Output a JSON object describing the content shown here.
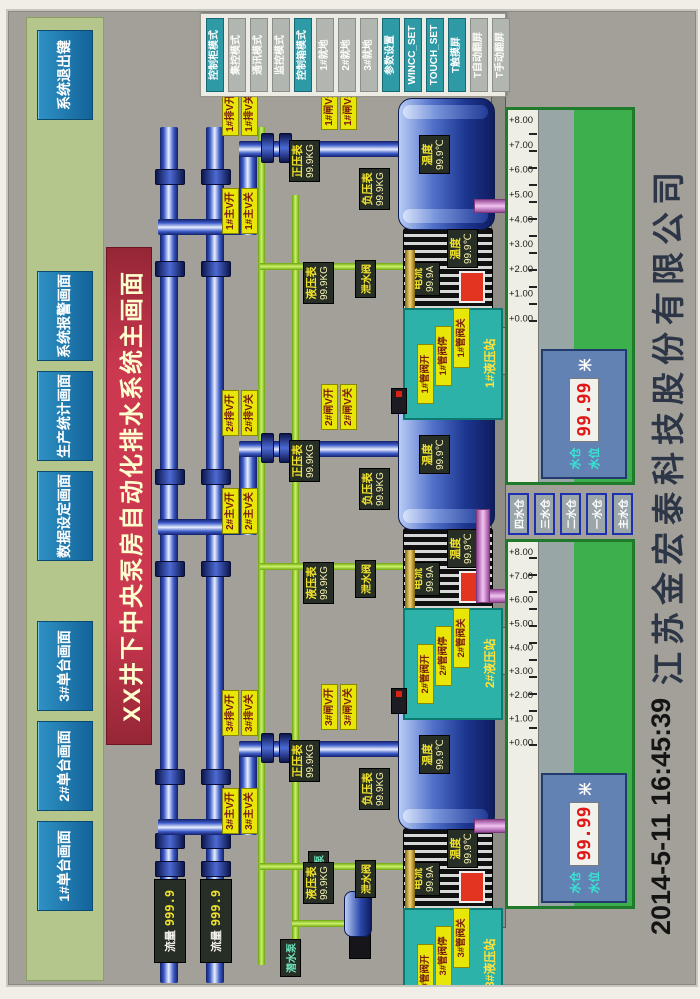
{
  "title": "XX井下中央泵房自动化排水系统主画面",
  "toolbar": {
    "buttons": [
      "1#单台画面",
      "2#单台画面",
      "3#单台画面",
      "数据设定画面",
      "生产统计画面",
      "系统报警画面",
      "系统退出键"
    ]
  },
  "mode_panel": {
    "buttons": [
      {
        "label": "控制柜模式",
        "variant": "teal"
      },
      {
        "label": "集控模式",
        "variant": "gray"
      },
      {
        "label": "通讯模式",
        "variant": "gray"
      },
      {
        "label": "监控模式",
        "variant": "gray"
      },
      {
        "label": "控制箱模式",
        "variant": "teal"
      },
      {
        "label": "1#就地",
        "variant": "gray"
      },
      {
        "label": "2#就地",
        "variant": "gray"
      },
      {
        "label": "3#就地",
        "variant": "gray"
      },
      {
        "label": "参数设置",
        "variant": "teal"
      },
      {
        "label": "WINCC_SET",
        "variant": "teal"
      },
      {
        "label": "TOUCH_SET",
        "variant": "teal"
      },
      {
        "label": "T触摸屏",
        "variant": "teal"
      },
      {
        "label": "T自动翻屏",
        "variant": "gray"
      },
      {
        "label": "T手动翻屏",
        "variant": "gray"
      }
    ]
  },
  "pumps": [
    {
      "id": "3#",
      "valves": {
        "drain_open": "3#排V开",
        "drain_close": "3#排V关",
        "main_open": "3#主V开",
        "main_close": "3#主V关",
        "gate_open": "3#闸V开",
        "gate_close": "3#闸V关"
      },
      "gauges": {
        "positive": {
          "label": "正压表",
          "value": "99.9KG"
        },
        "vacuum": {
          "label": "负压表",
          "value": "99.9KG"
        },
        "hydraulic": {
          "label": "液压表",
          "value": "99.9KG"
        },
        "drain_valve": "泄水阀"
      },
      "pump_temp": {
        "label": "温度",
        "value": "99.9℃"
      },
      "motor_current": {
        "label": "电流",
        "value": "99.9A"
      },
      "motor_temp": {
        "label": "温度",
        "value": "99.9℃"
      },
      "hydraulic_panel": {
        "open": "3#管阀开",
        "stop": "3#管阀停",
        "close": "3#管阀关",
        "station": "3#液压站"
      }
    },
    {
      "id": "2#",
      "valves": {
        "drain_open": "2#排V开",
        "drain_close": "2#排V关",
        "main_open": "2#主V开",
        "main_close": "2#主V关",
        "gate_open": "2#闸V开",
        "gate_close": "2#闸V关"
      },
      "gauges": {
        "positive": {
          "label": "正压表",
          "value": "99.9KG"
        },
        "vacuum": {
          "label": "负压表",
          "value": "99.9KG"
        },
        "hydraulic": {
          "label": "液压表",
          "value": "99.9KG"
        },
        "drain_valve": "泄水阀"
      },
      "pump_temp": {
        "label": "温度",
        "value": "99.9℃"
      },
      "motor_current": {
        "label": "电流",
        "value": "99.9A"
      },
      "motor_temp": {
        "label": "温度",
        "value": "99.9℃"
      },
      "hydraulic_panel": {
        "open": "2#管阀开",
        "stop": "2#管阀停",
        "close": "2#管阀关",
        "station": "2#液压站"
      }
    },
    {
      "id": "1#",
      "valves": {
        "drain_open": "1#排V开",
        "drain_close": "1#排V关",
        "main_open": "1#主V开",
        "main_close": "1#主V关",
        "gate_open": "1#闸V开",
        "gate_close": "1#闸V关"
      },
      "gauges": {
        "positive": {
          "label": "正压表",
          "value": "99.9KG"
        },
        "vacuum": {
          "label": "负压表",
          "value": "99.9KG"
        },
        "hydraulic": {
          "label": "液压表",
          "value": "99.9KG"
        },
        "drain_valve": "泄水阀"
      },
      "pump_temp": {
        "label": "温度",
        "value": "99.9℃"
      },
      "motor_current": {
        "label": "电流",
        "value": "99.9A"
      },
      "motor_temp": {
        "label": "温度",
        "value": "99.9℃"
      },
      "hydraulic_panel": {
        "open": "1#管阀开",
        "stop": "1#管阀停",
        "close": "1#管阀关",
        "station": "1#液压站"
      }
    }
  ],
  "flow_meters": [
    {
      "label": "流量",
      "value": "999.9"
    },
    {
      "label": "流量",
      "value": "999.9"
    }
  ],
  "tanks": [
    {
      "scale": [
        "+0.00",
        "+1.00",
        "+2.00",
        "+3.00",
        "+4.00",
        "+5.00",
        "+6.00",
        "+7.00",
        "+8.00"
      ],
      "display": {
        "line1": "水仓",
        "line2": "水位",
        "value": "99.99",
        "unit": "米"
      }
    },
    {
      "scale": [
        "+0.00",
        "+1.00",
        "+2.00",
        "+3.00",
        "+4.00",
        "+5.00",
        "+6.00",
        "+7.00",
        "+8.00"
      ],
      "display": {
        "line1": "水仓",
        "line2": "水位",
        "value": "99.99",
        "unit": "米"
      }
    }
  ],
  "sump_buttons": [
    "四水仓",
    "三水仓",
    "二水仓",
    "一水仓",
    "主水仓"
  ],
  "aux_pumps": {
    "submersible": "潜水泵",
    "jet": "射流泵"
  },
  "footer": {
    "datetime": "2014-5-11  16:45:39",
    "company": "江苏金宏泰科技股份有限公司"
  }
}
